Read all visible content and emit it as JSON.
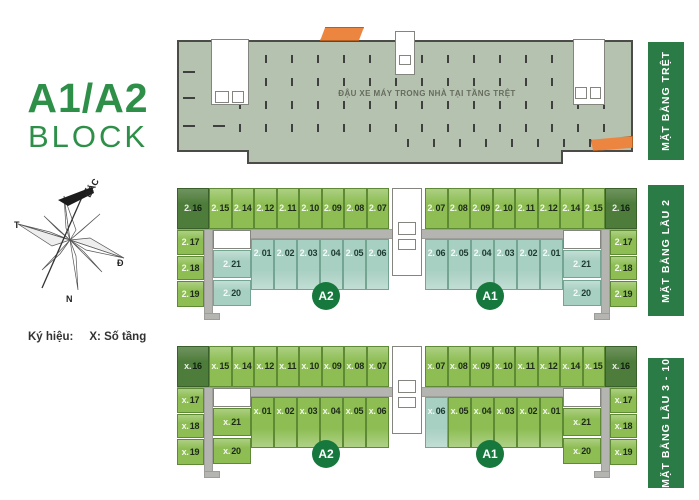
{
  "title": {
    "block_name": "A1/A2",
    "block_word": "BLOCK"
  },
  "compass": {
    "north_label": "BẮC",
    "west_label": "T",
    "east_label": "Đ",
    "south_label": "N"
  },
  "legend": {
    "label": "Ký hiệu:",
    "value": "X: Số tầng"
  },
  "side_labels": [
    {
      "text": "MẶT BẰNG TRỆT"
    },
    {
      "text": "MẶT BẰNG LẦU 2"
    },
    {
      "text": "MẶT BẰNG LẦU 3 - 10"
    }
  ],
  "ground_floor": {
    "note": "ĐẬU XE MÁY TRONG NHÀ TẠI TẦNG TRỆT"
  },
  "colors": {
    "brand_green": "#2e9048",
    "label_green": "#2b7b46",
    "badge_green": "#17783d",
    "unit_green": "#8dbd53",
    "unit_dark_green": "#4e7c3b",
    "unit_teal": "#a8d0c2",
    "parking_sage": "#b5c2af",
    "corridor_grey": "#b4b5b1",
    "ramp_orange": "#ec8540"
  },
  "floors": [
    {
      "id": "level-2",
      "wings": [
        {
          "badge": "A2",
          "side": "left",
          "top_row": [
            {
              "label": "2.16",
              "variant": "dark"
            },
            {
              "label": "2.15",
              "variant": "green"
            },
            {
              "label": "2.14",
              "variant": "green"
            },
            {
              "label": "2.12",
              "variant": "green"
            },
            {
              "label": "2.11",
              "variant": "green"
            },
            {
              "label": "2.10",
              "variant": "green"
            },
            {
              "label": "2.09",
              "variant": "green"
            },
            {
              "label": "2.08",
              "variant": "green"
            },
            {
              "label": "2.07",
              "variant": "green"
            }
          ],
          "side_col": [
            {
              "label": "2.17",
              "variant": "green"
            },
            {
              "label": "2.18",
              "variant": "green"
            },
            {
              "label": "2.19",
              "variant": "green"
            }
          ],
          "inner": [
            {
              "label": "2.21",
              "variant": "teal"
            },
            {
              "label": "2.20",
              "variant": "teal"
            }
          ],
          "bottom_row": [
            {
              "label": "2.01",
              "variant": "teal"
            },
            {
              "label": "2.02",
              "variant": "teal"
            },
            {
              "label": "2.03",
              "variant": "teal"
            },
            {
              "label": "2.04",
              "variant": "teal"
            },
            {
              "label": "2.05",
              "variant": "teal"
            },
            {
              "label": "2.06",
              "variant": "teal"
            }
          ]
        },
        {
          "badge": "A1",
          "side": "right",
          "top_row": [
            {
              "label": "2.07",
              "variant": "green"
            },
            {
              "label": "2.08",
              "variant": "green"
            },
            {
              "label": "2.09",
              "variant": "green"
            },
            {
              "label": "2.10",
              "variant": "green"
            },
            {
              "label": "2.11",
              "variant": "green"
            },
            {
              "label": "2.12",
              "variant": "green"
            },
            {
              "label": "2.14",
              "variant": "green"
            },
            {
              "label": "2.15",
              "variant": "green"
            },
            {
              "label": "2.16",
              "variant": "dark"
            }
          ],
          "side_col": [
            {
              "label": "2.17",
              "variant": "green"
            },
            {
              "label": "2.18",
              "variant": "green"
            },
            {
              "label": "2.19",
              "variant": "green"
            }
          ],
          "inner": [
            {
              "label": "2.21",
              "variant": "teal"
            },
            {
              "label": "2.20",
              "variant": "teal"
            }
          ],
          "bottom_row": [
            {
              "label": "2.06",
              "variant": "teal"
            },
            {
              "label": "2.05",
              "variant": "teal"
            },
            {
              "label": "2.04",
              "variant": "teal"
            },
            {
              "label": "2.03",
              "variant": "teal"
            },
            {
              "label": "2.02",
              "variant": "teal"
            },
            {
              "label": "2.01",
              "variant": "teal"
            }
          ]
        }
      ]
    },
    {
      "id": "level-3-10",
      "wings": [
        {
          "badge": "A2",
          "side": "left",
          "top_row": [
            {
              "label": "x.16",
              "variant": "dark"
            },
            {
              "label": "x.15",
              "variant": "green"
            },
            {
              "label": "x.14",
              "variant": "green"
            },
            {
              "label": "x.12",
              "variant": "green"
            },
            {
              "label": "x.11",
              "variant": "green"
            },
            {
              "label": "x.10",
              "variant": "green"
            },
            {
              "label": "x.09",
              "variant": "green"
            },
            {
              "label": "x.08",
              "variant": "green"
            },
            {
              "label": "x.07",
              "variant": "green"
            }
          ],
          "side_col": [
            {
              "label": "x.17",
              "variant": "green"
            },
            {
              "label": "x.18",
              "variant": "green"
            },
            {
              "label": "x.19",
              "variant": "green"
            }
          ],
          "inner": [
            {
              "label": "x.21",
              "variant": "green"
            },
            {
              "label": "x.20",
              "variant": "green"
            }
          ],
          "bottom_row": [
            {
              "label": "x.01",
              "variant": "green"
            },
            {
              "label": "x.02",
              "variant": "green"
            },
            {
              "label": "x.03",
              "variant": "green"
            },
            {
              "label": "x.04",
              "variant": "green"
            },
            {
              "label": "x.05",
              "variant": "green"
            },
            {
              "label": "x.06",
              "variant": "green"
            }
          ]
        },
        {
          "badge": "A1",
          "side": "right",
          "top_row": [
            {
              "label": "x.07",
              "variant": "green"
            },
            {
              "label": "x.08",
              "variant": "green"
            },
            {
              "label": "x.09",
              "variant": "green"
            },
            {
              "label": "x.10",
              "variant": "green"
            },
            {
              "label": "x.11",
              "variant": "green"
            },
            {
              "label": "x.12",
              "variant": "green"
            },
            {
              "label": "x.14",
              "variant": "green"
            },
            {
              "label": "x.15",
              "variant": "green"
            },
            {
              "label": "x.16",
              "variant": "dark"
            }
          ],
          "side_col": [
            {
              "label": "x.17",
              "variant": "green"
            },
            {
              "label": "x.18",
              "variant": "green"
            },
            {
              "label": "x.19",
              "variant": "green"
            }
          ],
          "inner": [
            {
              "label": "x.21",
              "variant": "green"
            },
            {
              "label": "x.20",
              "variant": "green"
            }
          ],
          "bottom_row": [
            {
              "label": "x.06",
              "variant": "teal"
            },
            {
              "label": "x.05",
              "variant": "green"
            },
            {
              "label": "x.04",
              "variant": "green"
            },
            {
              "label": "x.03",
              "variant": "green"
            },
            {
              "label": "x.02",
              "variant": "green"
            },
            {
              "label": "x.01",
              "variant": "green"
            }
          ]
        }
      ]
    }
  ]
}
